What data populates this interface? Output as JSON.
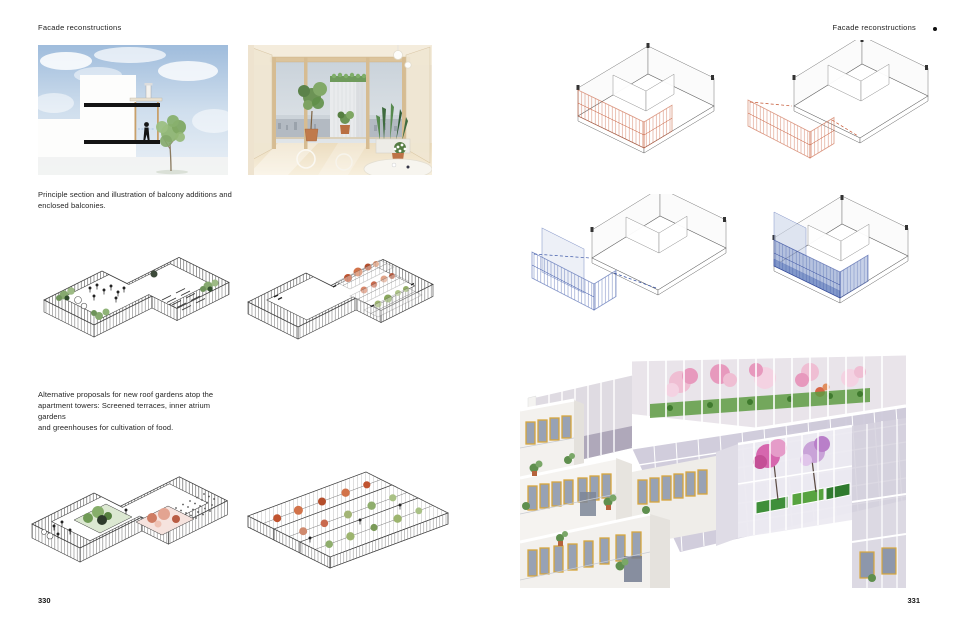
{
  "book": {
    "left_page": {
      "header": "Facade reconstructions",
      "page_number": "330",
      "captions": {
        "balcony": {
          "lines": [
            "Principle section and illustration of balcony additions and",
            "enclosed balconies."
          ]
        },
        "roof_gardens": {
          "lines": [
            "Alternative proposals for new roof gardens atop the",
            "apartment towers: Screened terraces, inner atrium gardens",
            "and greenhouses for cultivation of food."
          ]
        }
      }
    },
    "right_page": {
      "header": "Facade reconstructions",
      "page_number": "331"
    }
  },
  "colors": {
    "page_background": "#ffffff",
    "text": "#1d1d1d",
    "drawing_line": "#3a3a3a",
    "accent_red": "#c4532f",
    "accent_blue": "#3450a4",
    "foliage_green": "#86a96f",
    "greenhouse_tree_red": "#c0532f",
    "blossom_pink": "#e291b6",
    "blossom_magenta": "#d667ae",
    "blossom_lilac": "#c9a3d8",
    "planter_green": "#3f8f3a",
    "window_frame_gold": "#d7a63c",
    "facade_white": "#f2f0ed",
    "glass_lavender": "#ccc8d8",
    "sky_blue": "#9fbcdc",
    "wood_beige": "#d6bc92"
  }
}
